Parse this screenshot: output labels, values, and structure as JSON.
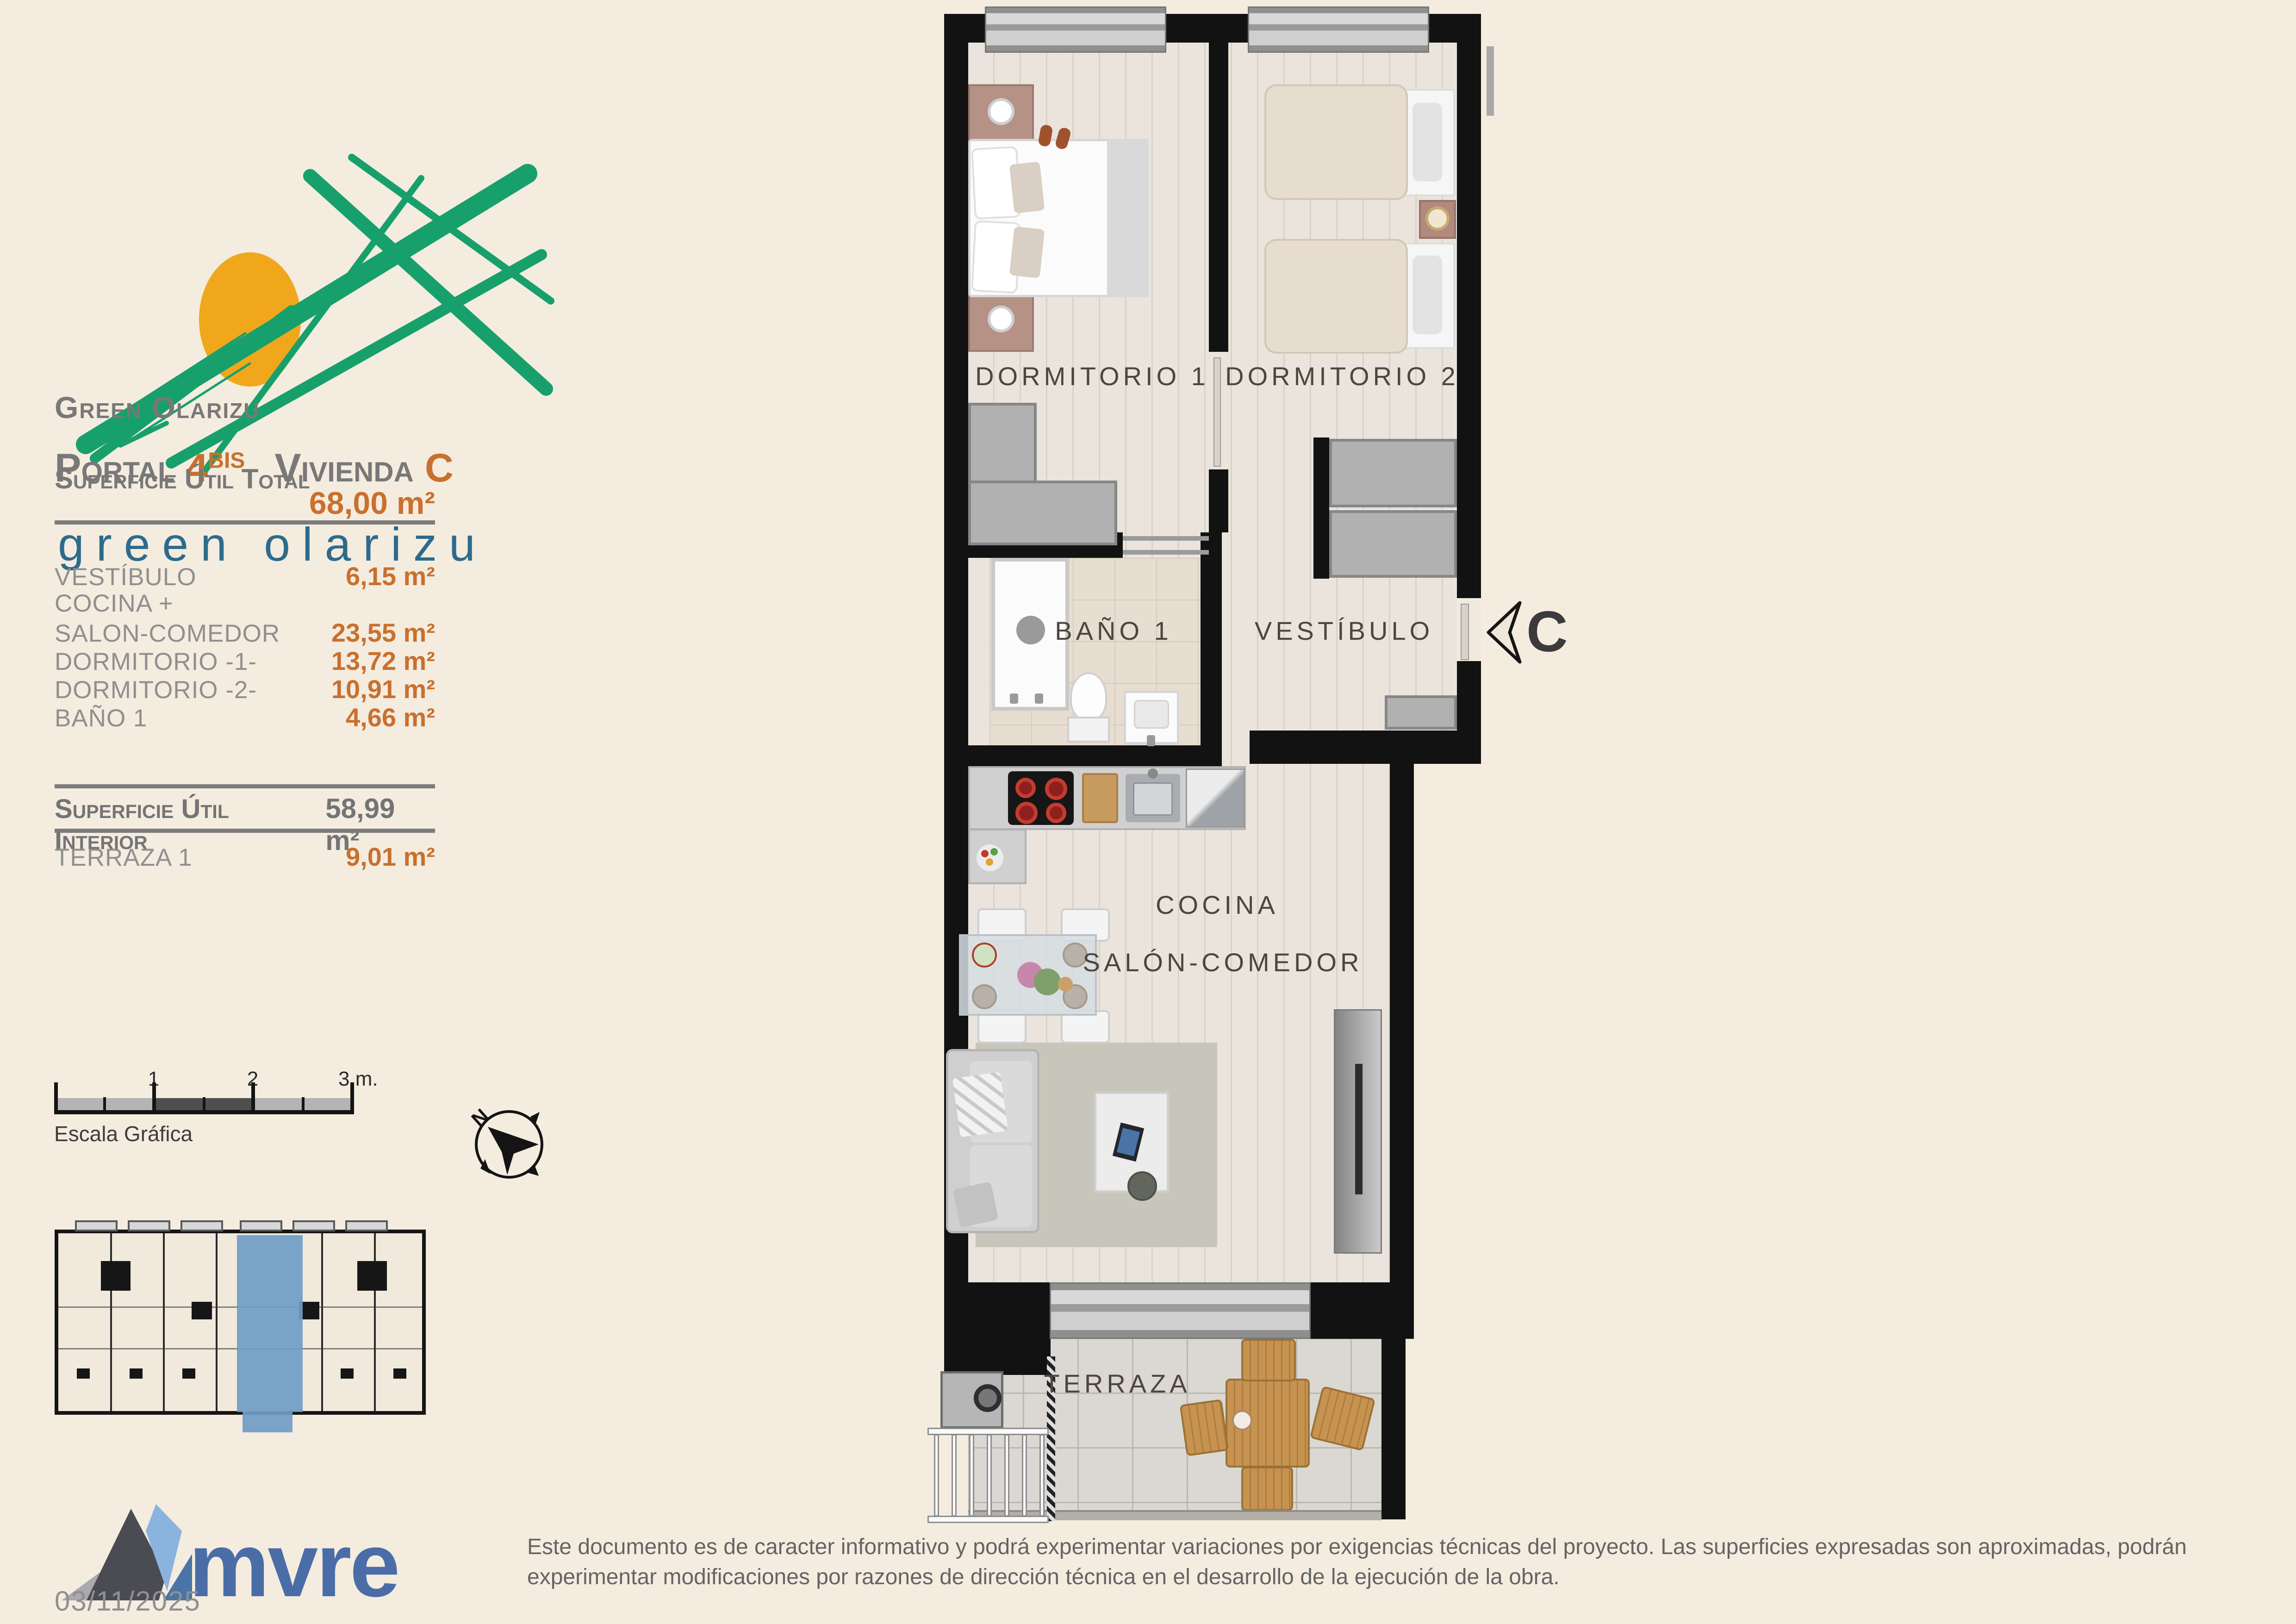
{
  "branding": {
    "logo_text": "green olarizu",
    "heading_line1": "Green Olarizu",
    "portal_label": "Portal",
    "portal_number": "4",
    "portal_suffix": "BIS",
    "vivienda_label": "Vivienda",
    "vivienda_letter": "C"
  },
  "areas": {
    "total_label": "Superficie Útil Total",
    "total_value": "68,00 m²",
    "rows": [
      {
        "label": "VESTÍBULO",
        "value": "6,15 m²"
      },
      {
        "label": "COCINA +",
        "value": ""
      },
      {
        "label": "SALON-COMEDOR",
        "value": "23,55 m²"
      },
      {
        "label": "DORMITORIO -1-",
        "value": "13,72 m²"
      },
      {
        "label": "DORMITORIO -2-",
        "value": "10,91 m²"
      },
      {
        "label": "BAÑO 1",
        "value": "4,66 m²"
      }
    ],
    "interior_label": "Superficie Útil Interior",
    "interior_value": "58,99 m²",
    "terraza_label": "TERRAZA 1",
    "terraza_value": "9,01 m²"
  },
  "scale_bar": {
    "labels": [
      "1",
      "2",
      "3 m."
    ],
    "caption": "Escala Gráfica"
  },
  "compass": {
    "north_label": "N"
  },
  "plan": {
    "rooms": {
      "dormitorio1": "DORMITORIO 1",
      "dormitorio2": "DORMITORIO 2",
      "bano": "BAÑO 1",
      "vestibulo": "VESTÍBULO",
      "cocina": "COCINA",
      "salon": "SALÓN-COMEDOR",
      "terraza": "TERRAZA"
    },
    "entrance_marker": "C"
  },
  "footer": {
    "company": "mvre",
    "date": "03/11/2025",
    "disclaimer": "Este documento es de caracter informativo y podrá experimentar variaciones por exigencias técnicas del proyecto. Las superficies expresadas son aproximadas, podrán experimentar modificaciones por razones de dirección técnica en el desarrollo de la ejecución de la obra."
  },
  "colors": {
    "background": "#f4ecdf",
    "accent_orange": "#c9702e",
    "heading_gray": "#787878",
    "logo_green": "#17a06b",
    "logo_sun": "#f0a71c",
    "logo_blue": "#2d6b8c",
    "mvre_blue": "#4a6da7",
    "unit_highlight": "#6f9cc4",
    "wall": "#121212"
  }
}
